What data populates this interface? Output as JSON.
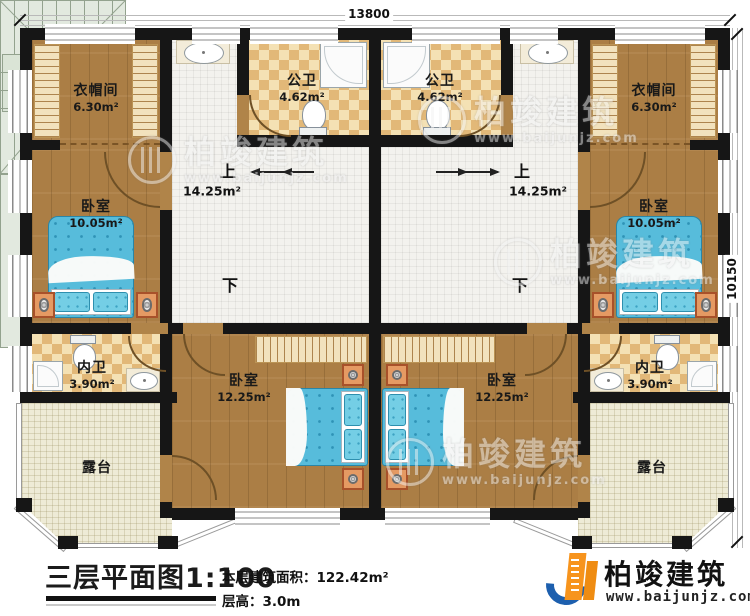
{
  "dimensions": {
    "top": "13800",
    "right": "10150"
  },
  "rooms": {
    "cloakroom_l": {
      "name": "衣帽间",
      "area": "6.30m²"
    },
    "cloakroom_r": {
      "name": "衣帽间",
      "area": "6.30m²"
    },
    "bath_l": {
      "name": "公卫",
      "area": "4.62m²"
    },
    "bath_r": {
      "name": "公卫",
      "area": "4.62m²"
    },
    "bedroom_l": {
      "name": "卧室",
      "area": "10.05m²"
    },
    "bedroom_r": {
      "name": "卧室",
      "area": "10.05m²"
    },
    "wc_l": {
      "name": "内卫",
      "area": "3.90m²"
    },
    "wc_r": {
      "name": "内卫",
      "area": "3.90m²"
    },
    "bedroom_bl": {
      "name": "卧室",
      "area": "12.25m²"
    },
    "bedroom_br": {
      "name": "卧室",
      "area": "12.25m²"
    },
    "terrace_l": {
      "name": "露台"
    },
    "terrace_r": {
      "name": "露台"
    }
  },
  "stairs": {
    "up": "上",
    "down": "下",
    "area": "14.25m²"
  },
  "title": {
    "main": "三层平面图1:100",
    "building_area": "本层建筑面积：122.42m²",
    "floor_height": "层高：3.0m"
  },
  "brand": {
    "name": "柏竣建筑",
    "url": "www.baijunjz.com"
  },
  "watermark": {
    "name": "柏竣建筑",
    "url": "www.baijunjz.com"
  },
  "colors": {
    "wall": "#161616",
    "wood_floor": "#ab7e45",
    "bath_tile": "#e2b878",
    "stair": "#e2e9df",
    "terrace": "#eeebd6",
    "bed": "#57bcdb",
    "brand_blue": "#1d5fae",
    "brand_orange": "#f7941d"
  }
}
